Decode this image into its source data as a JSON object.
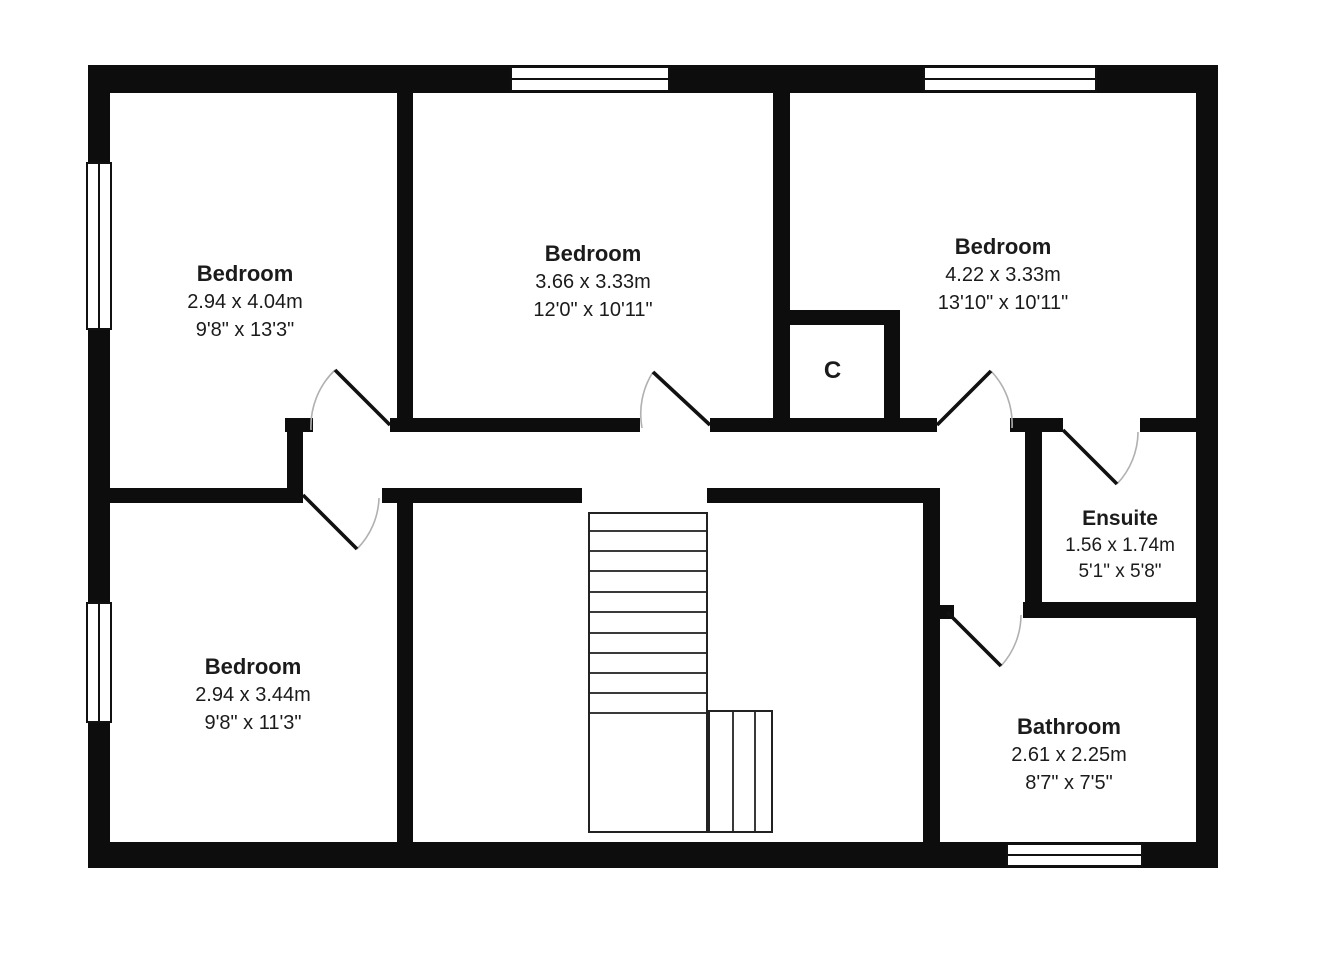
{
  "plan": {
    "rooms": [
      {
        "name": "Bedroom",
        "metric": "2.94 x 4.04m",
        "imperial": "9'8\" x 13'3\""
      },
      {
        "name": "Bedroom",
        "metric": "3.66 x 3.33m",
        "imperial": "12'0\" x 10'11\""
      },
      {
        "name": "Bedroom",
        "metric": "4.22 x 3.33m",
        "imperial": "13'10\" x 10'11\""
      },
      {
        "name": "Ensuite",
        "metric": "1.56 x 1.74m",
        "imperial": "5'1\" x 5'8\""
      },
      {
        "name": "Bedroom",
        "metric": "2.94 x 3.44m",
        "imperial": "9'8\" x 11'3\""
      },
      {
        "name": "Bathroom",
        "metric": "2.61 x 2.25m",
        "imperial": "8'7\" x 7'5\""
      }
    ],
    "closet_label": "C",
    "colors": {
      "wall": "#0d0d0d",
      "text": "#1b1b1b",
      "door_arc": "#b0b0b0",
      "background": "#ffffff"
    }
  }
}
